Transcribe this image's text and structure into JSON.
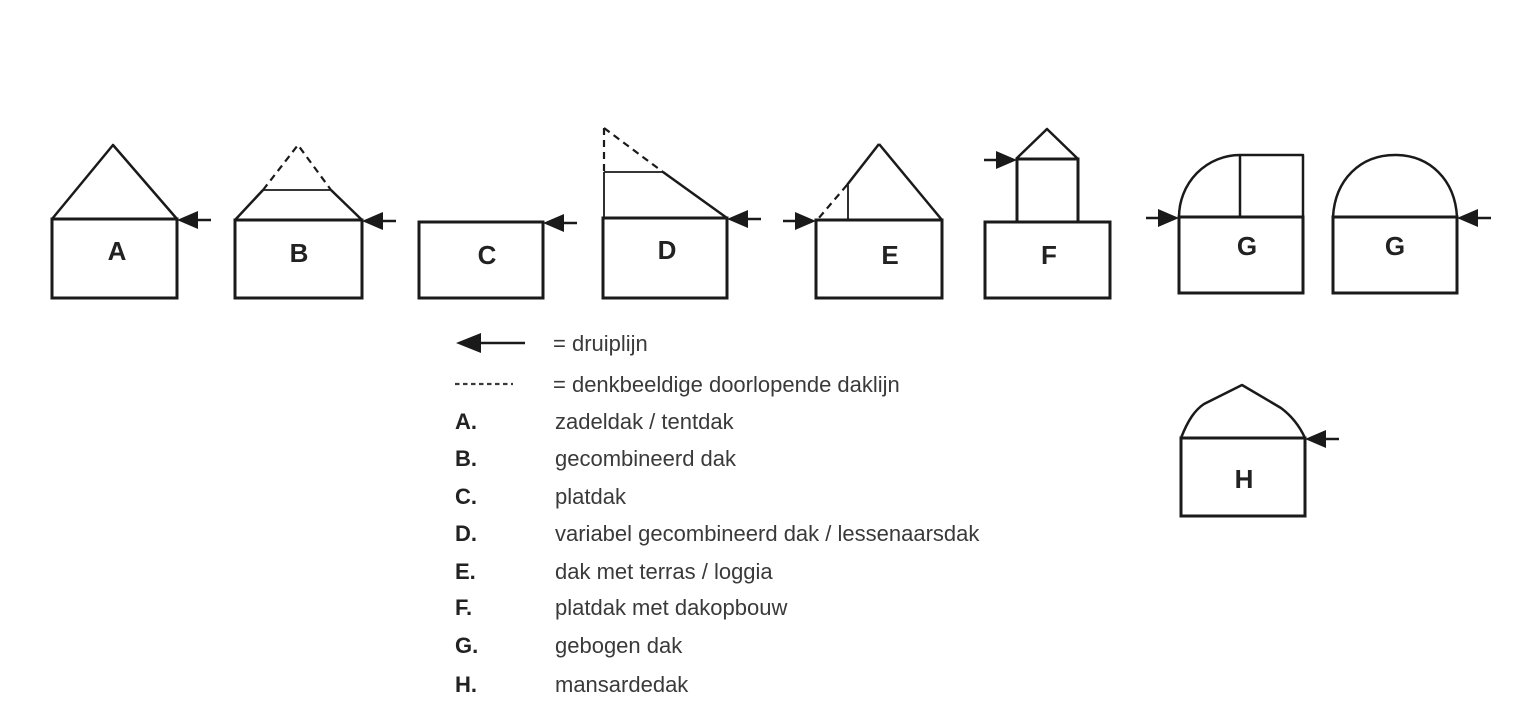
{
  "title": "dakvormen-diagram",
  "colors": {
    "line": "#1a1a1a",
    "text": "#3a3a3a",
    "background": "#ffffff"
  },
  "houses": {
    "a": "A",
    "b": "B",
    "c": "C",
    "d": "D",
    "e": "E",
    "f": "F",
    "g1": "G",
    "g2": "G",
    "h": "H"
  },
  "legend": {
    "arrow_label": "= druiplijn",
    "dashed_label": "= denkbeeldige doorlopende daklijn",
    "items": [
      {
        "key": "A.",
        "label": "zadeldak / tentdak"
      },
      {
        "key": "B.",
        "label": "gecombineerd dak"
      },
      {
        "key": "C.",
        "label": "platdak"
      },
      {
        "key": "D.",
        "label": "variabel gecombineerd dak / lessenaarsdak"
      },
      {
        "key": "E.",
        "label": "dak met terras / loggia"
      },
      {
        "key": "F.",
        "label": "platdak met dakopbouw"
      },
      {
        "key": "G.",
        "label": "gebogen dak"
      },
      {
        "key": "H.",
        "label": "mansardedak"
      }
    ]
  }
}
